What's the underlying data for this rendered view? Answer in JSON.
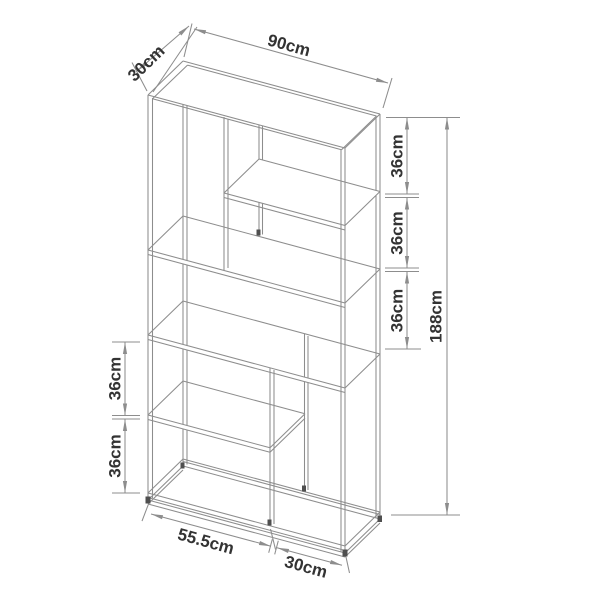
{
  "figure": {
    "background": "#ffffff",
    "line_color": "#8d8d8d",
    "joint_color": "#4f4f4f",
    "label_color": "#333333"
  },
  "dimensions": {
    "top_width": "90cm",
    "top_depth": "30cm",
    "right_side": [
      "36cm",
      "36cm",
      "36cm"
    ],
    "total_height": "188cm",
    "left_side": [
      "36cm",
      "36cm"
    ],
    "bottom_left": "55.5cm",
    "bottom_right": "30cm"
  }
}
